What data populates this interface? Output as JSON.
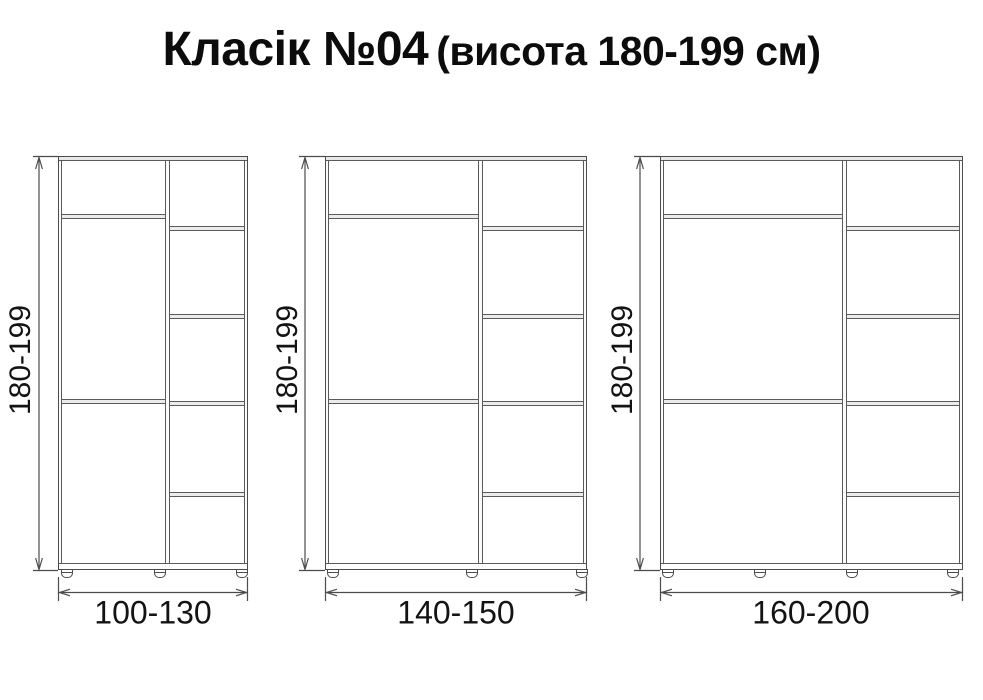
{
  "title": {
    "main": "Класік №04",
    "sub": "(висота 180-199 см)"
  },
  "wardrobes": [
    {
      "key": "small",
      "height_label": "180-199",
      "width_label": "100-130"
    },
    {
      "key": "medium",
      "height_label": "180-199",
      "width_label": "140-150"
    },
    {
      "key": "large",
      "height_label": "180-199",
      "width_label": "160-200"
    }
  ],
  "colors": {
    "background": "#ffffff",
    "line": "#4c4c4c",
    "text": "#131313",
    "panel_fill": "#e9e9e9"
  }
}
